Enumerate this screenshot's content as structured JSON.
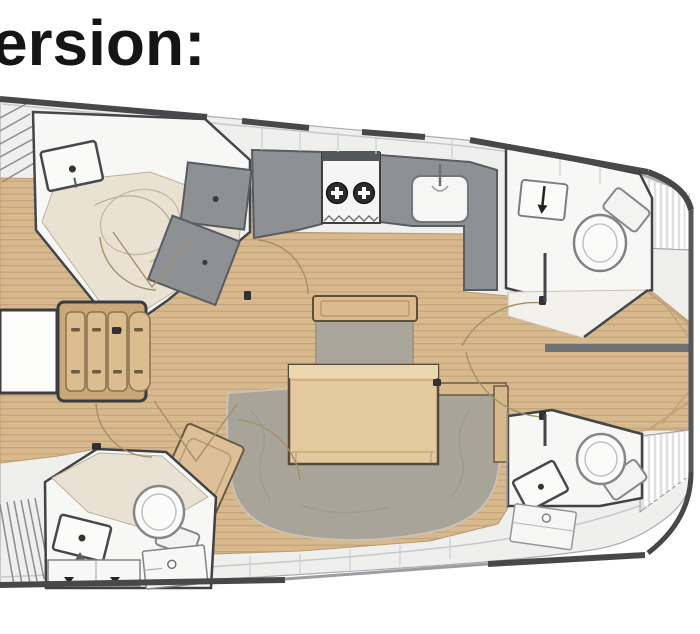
{
  "title": {
    "text": "ersion:"
  },
  "colors": {
    "background": "#ffffff",
    "title_text": "#151515",
    "deck_white": "#efefee",
    "hull_gunwale_dark": "#46484a",
    "wood_floor": "#d8b98e",
    "wood_plank_line": "#c3a379",
    "module_gray": "#8e9194",
    "cream_shower_floor": "#e9e2d3",
    "fixture_white": "#f9f9f8",
    "sofa_taupe": "#a9a499",
    "table_wood": "#e4c99f",
    "bed_cushion_tan": "#dcbd8f",
    "divider_gray": "#6f7274",
    "burner_dark": "#2c2c2c"
  },
  "floorplan": {
    "type": "sailing-yacht-interior-layout",
    "orientation": "bow-left-stern-right",
    "regions": [
      "bow-hatch-forward",
      "bow-hatch-aft",
      "forward-berth",
      "forward-head",
      "shower-module",
      "galley",
      "stove-two-burners",
      "galley-sink",
      "salon-table",
      "salon-sofa-u",
      "salon-bench",
      "salon-backrest",
      "nav-desk",
      "aft-starboard-head",
      "aft-port-head",
      "toilet",
      "washbasin",
      "cockpit-floor",
      "cockpit-bench-slats",
      "companionway-divider",
      "stern-transom"
    ]
  }
}
